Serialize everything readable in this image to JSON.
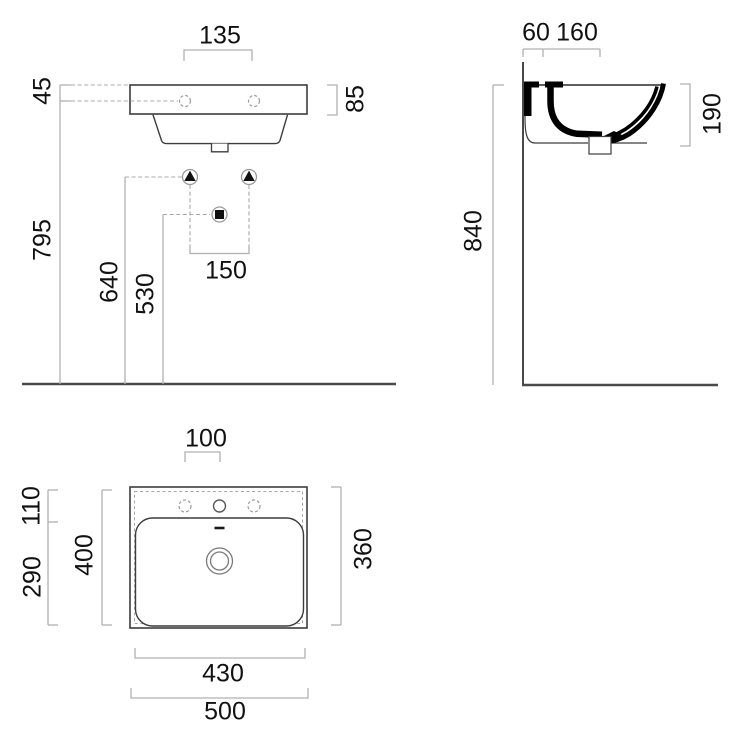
{
  "drawing": {
    "type": "washbasin-technical-drawing",
    "views": {
      "front": "front elevation",
      "side": "side section",
      "plan": "top plan"
    },
    "dims": {
      "front_135": "135",
      "front_45": "45",
      "front_85": "85",
      "front_795": "795",
      "front_640": "640",
      "front_530": "530",
      "front_150": "150",
      "side_60": "60",
      "side_160": "160",
      "side_840": "840",
      "side_190": "190",
      "plan_100": "100",
      "plan_110": "110",
      "plan_290": "290",
      "plan_400": "400",
      "plan_360": "360",
      "plan_430": "430",
      "plan_500": "500"
    },
    "symbols": {
      "mount_bolt": "triangle-marker",
      "drain_outlet": "square-marker"
    },
    "colors": {
      "background": "#ffffff",
      "outline": "#3c3c3c",
      "section_fill": "#000000",
      "dim_line": "#b0b0b0",
      "heavy_line": "#4a4a4a",
      "text": "#111111"
    }
  }
}
